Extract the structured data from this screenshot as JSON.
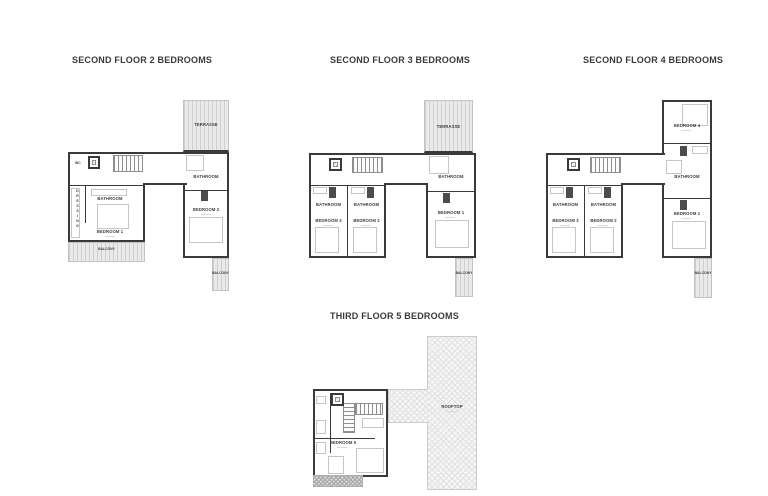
{
  "page": {
    "background": "#ffffff",
    "wall_color": "#3a3a3a",
    "hatch_color": "#d9d9d9"
  },
  "plans": [
    {
      "title": "SECOND FLOOR 2 BEDROOMS",
      "rooms": {
        "terrasse": "TERRASSE",
        "wc": "WC",
        "dressing": "DRESSING",
        "bathroom": "BATHROOM",
        "bedroom_1": "BEDROOM 1",
        "bedroom_2": "BEDROOM 2",
        "balcony": "BALCONY"
      }
    },
    {
      "title": "SECOND FLOOR 3 BEDROOMS",
      "rooms": {
        "terrasse": "TERRASSE",
        "bathroom": "BATHROOM",
        "bedroom_1": "BEDROOM 1",
        "bedroom_2": "BEDROOM 2",
        "bedroom_3": "BEDROOM 3",
        "balcony": "BALCONY"
      }
    },
    {
      "title": "SECOND FLOOR 4 BEDROOMS",
      "rooms": {
        "bedroom_4": "BEDROOM 4",
        "bathroom": "BATHROOM",
        "bedroom_1": "BEDROOM 1",
        "bedroom_2": "BEDROOM 2",
        "bedroom_3": "BEDROOM 3",
        "balcony": "BALCONY"
      }
    },
    {
      "title": "THIRD FLOOR 5 BEDROOMS",
      "rooms": {
        "rooftop": "ROOFTOP",
        "bedroom_5": "BEDROOM 5"
      }
    }
  ]
}
